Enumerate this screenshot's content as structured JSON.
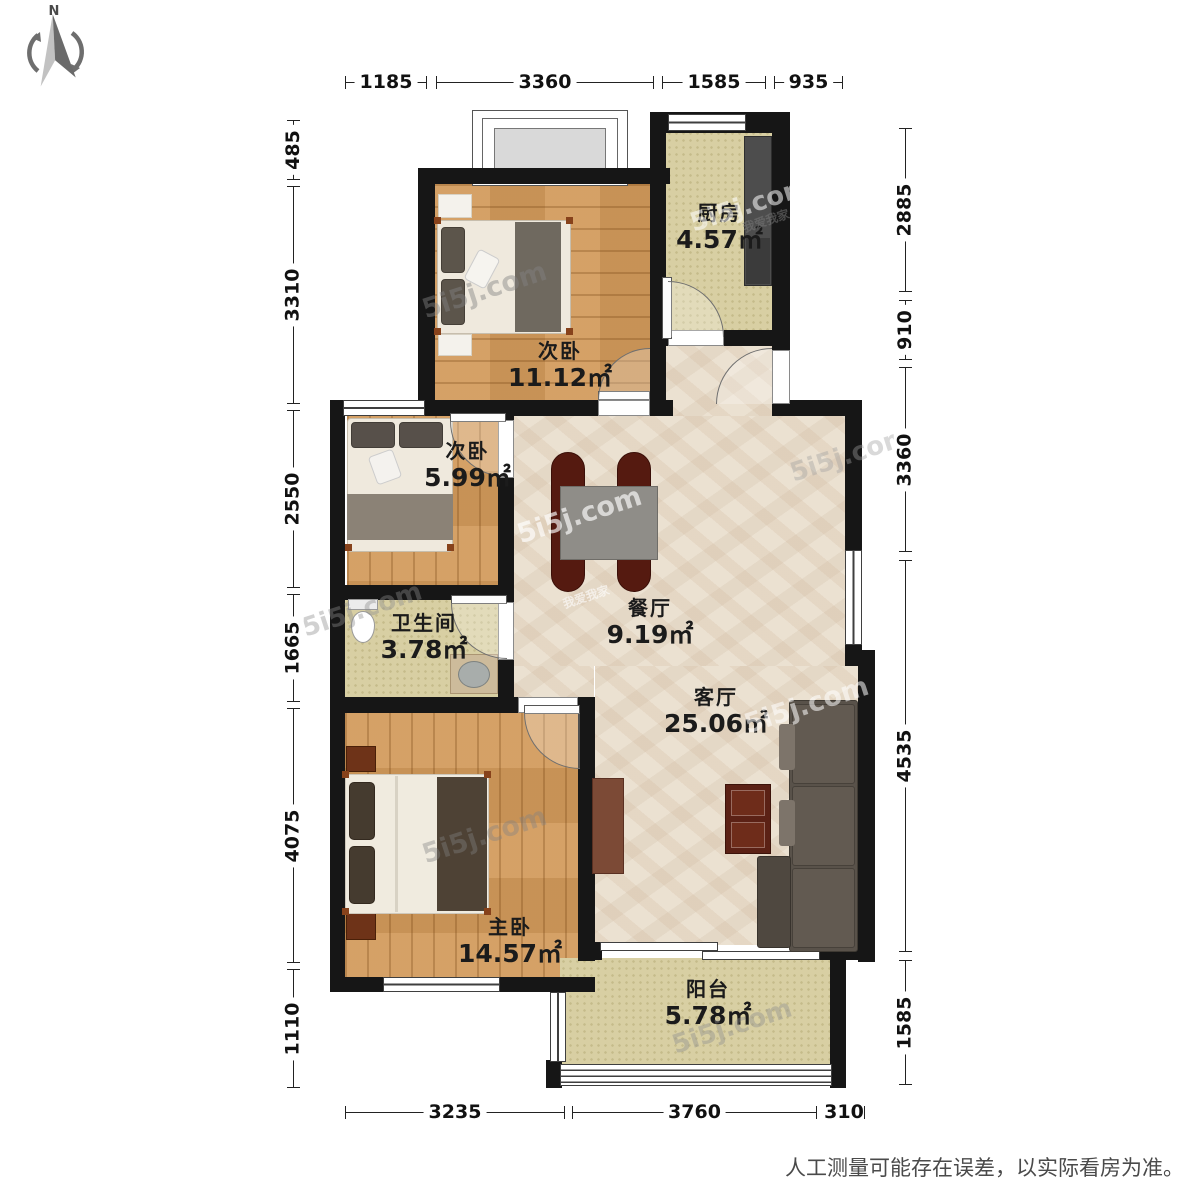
{
  "compass": {
    "label": "N"
  },
  "watermark": {
    "text": "5i5j.com",
    "cn": "我爱我家"
  },
  "disclaimer": "人工测量可能存在误差，以实际看房为准。",
  "dimensions": {
    "top": [
      "1185",
      "3360",
      "1585",
      "935"
    ],
    "bottom": [
      "3235",
      "3760",
      "310"
    ],
    "left": [
      "485",
      "3310",
      "2550",
      "1665",
      "4075",
      "1110"
    ],
    "right": [
      "2885",
      "910",
      "3360",
      "4535",
      "1585"
    ]
  },
  "rooms": [
    {
      "id": "bedroom-second-large",
      "name": "次卧",
      "area": "11.12㎡"
    },
    {
      "id": "kitchen",
      "name": "厨房",
      "area": "4.57㎡"
    },
    {
      "id": "bedroom-second-small",
      "name": "次卧",
      "area": "5.99㎡"
    },
    {
      "id": "dining-room",
      "name": "餐厅",
      "area": "9.19㎡"
    },
    {
      "id": "bathroom",
      "name": "卫生间",
      "area": "3.78㎡"
    },
    {
      "id": "living-room",
      "name": "客厅",
      "area": "25.06㎡"
    },
    {
      "id": "master-bedroom",
      "name": "主卧",
      "area": "14.57㎡"
    },
    {
      "id": "balcony",
      "name": "阳台",
      "area": "5.78㎡"
    }
  ],
  "colors": {
    "wall": "#161616",
    "wood_floor": "#d29a5b",
    "tile_floor": "#d8cfa3",
    "marble_floor": "#ebe1d1",
    "counter": "#4d4d4d",
    "sofa": "#59524a",
    "dining_chair": "#551a10",
    "accent_wood": "#6e3318"
  }
}
